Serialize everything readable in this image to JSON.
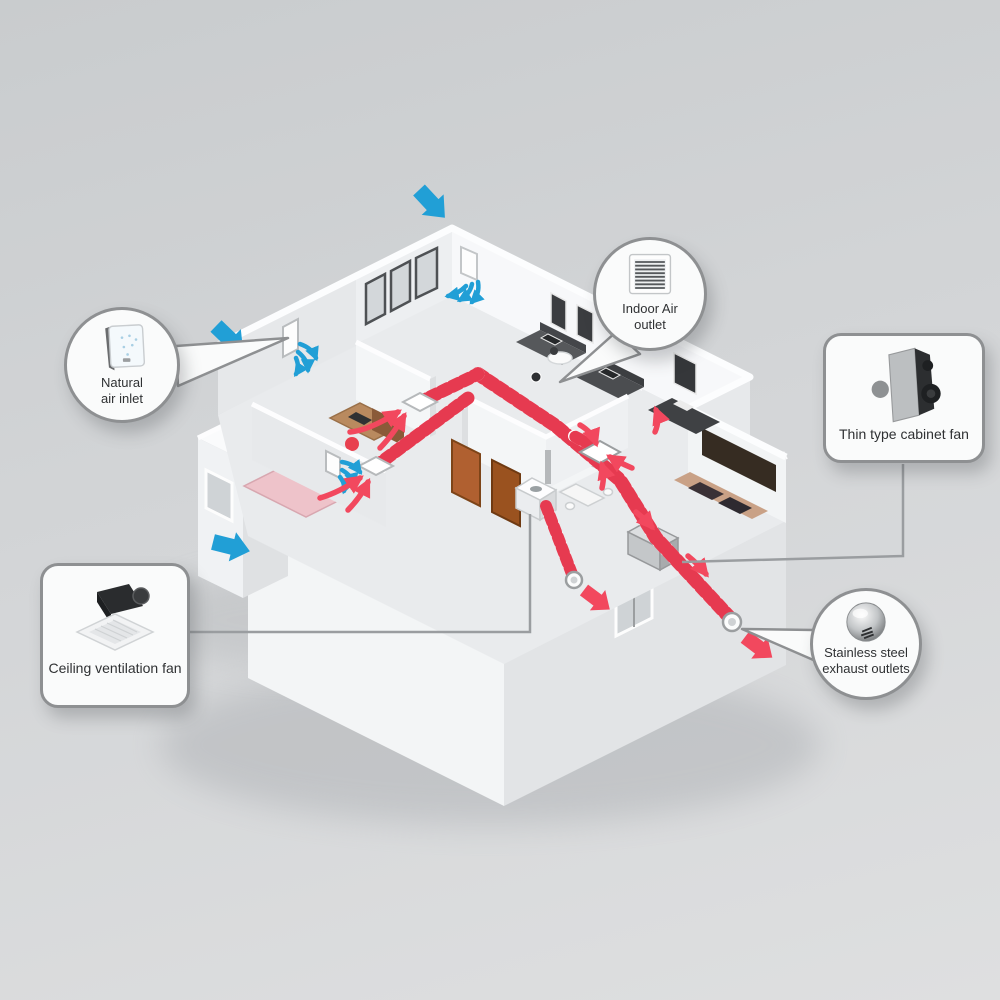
{
  "title": "Home ventilation system diagram",
  "colors": {
    "bg_from": "#c9ccce",
    "bg_mid": "#d3d5d7",
    "bg_to": "#dedfe0",
    "inlet_blue": "#219fd6",
    "exhaust_red": "#f2485e",
    "duct_red": "#e63a50",
    "callout_border": "#8e9092",
    "callout_bg": "#fafbfb",
    "text": "#2f3133"
  },
  "callouts": {
    "natural_air_inlet": {
      "lines": [
        "Natural",
        "air inlet"
      ],
      "icon": "wall-inlet-fan-icon",
      "shape": "circle"
    },
    "indoor_air_outlet": {
      "lines": [
        "Indoor Air",
        "outlet"
      ],
      "icon": "grille-vent-icon",
      "shape": "circle"
    },
    "thin_type_cabinet_fan": {
      "label": "Thin type cabinet fan",
      "icon": "cabinet-fan-icon",
      "shape": "rounded-box"
    },
    "ceiling_ventilation_fan": {
      "label": "Ceiling ventilation fan",
      "icon": "ceiling-fan-icon",
      "shape": "rounded-box"
    },
    "stainless_steel_exhaust_outlets": {
      "lines": [
        "Stainless steel",
        "exhaust outlets"
      ],
      "icon": "steel-dome-outlet-icon",
      "shape": "circle"
    }
  },
  "legend_semantics": {
    "blue_arrows": "fresh air entering through natural inlets",
    "red_arrows": "indoor exhaust air flow to outlets",
    "striped_duct": "exhaust duct run"
  }
}
